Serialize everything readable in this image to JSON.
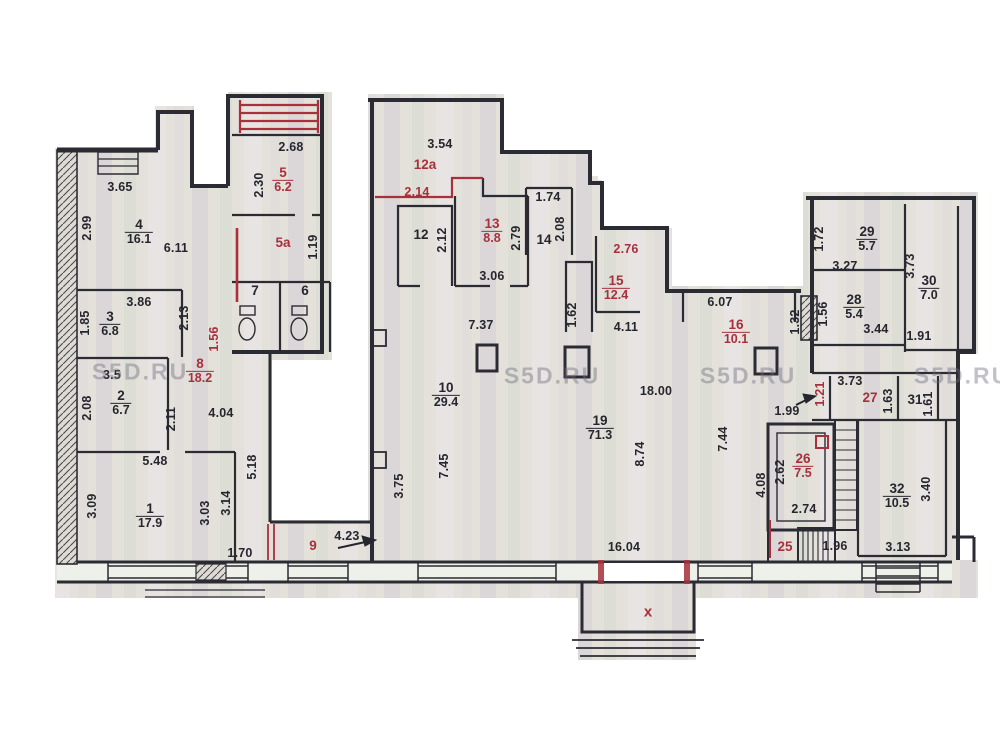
{
  "watermark": {
    "text": "S5D.RU",
    "positions": [
      {
        "x": 140,
        "y": 372
      },
      {
        "x": 552,
        "y": 376
      },
      {
        "x": 748,
        "y": 376
      },
      {
        "x": 962,
        "y": 376
      }
    ]
  },
  "marks": {
    "porch_x": {
      "text": "x",
      "x": 648,
      "y": 612
    }
  },
  "colors": {
    "red": "#a8303c",
    "ink": "#26262e",
    "scan": "#e4e1da"
  },
  "rooms": [
    {
      "num": "1",
      "area": "17.9",
      "x": 150,
      "y": 516,
      "red": false
    },
    {
      "num": "2",
      "area": "6.7",
      "x": 121,
      "y": 403,
      "red": false
    },
    {
      "num": "3",
      "area": "6.8",
      "x": 110,
      "y": 324,
      "red": false
    },
    {
      "num": "4",
      "area": "16.1",
      "x": 139,
      "y": 232,
      "red": false
    },
    {
      "num": "5",
      "area": "6.2",
      "x": 283,
      "y": 180,
      "red": true
    },
    {
      "num": "5a",
      "area": "",
      "x": 283,
      "y": 243,
      "red": true
    },
    {
      "num": "7",
      "area": "",
      "x": 255,
      "y": 291,
      "red": false
    },
    {
      "num": "6",
      "area": "",
      "x": 305,
      "y": 291,
      "red": false
    },
    {
      "num": "8",
      "area": "18.2",
      "x": 200,
      "y": 371,
      "red": true
    },
    {
      "num": "9",
      "area": "",
      "x": 313,
      "y": 546,
      "red": true
    },
    {
      "num": "10",
      "area": "29.4",
      "x": 446,
      "y": 395,
      "red": false
    },
    {
      "num": "12",
      "area": "",
      "x": 421,
      "y": 235,
      "red": false
    },
    {
      "num": "12a",
      "area": "",
      "x": 425,
      "y": 165,
      "red": true
    },
    {
      "num": "13",
      "area": "8.8",
      "x": 492,
      "y": 231,
      "red": true
    },
    {
      "num": "14",
      "area": "",
      "x": 544,
      "y": 240,
      "red": false
    },
    {
      "num": "15",
      "area": "12.4",
      "x": 616,
      "y": 288,
      "red": true
    },
    {
      "num": "16",
      "area": "10.1",
      "x": 736,
      "y": 332,
      "red": true
    },
    {
      "num": "19",
      "area": "71.3",
      "x": 600,
      "y": 428,
      "red": false
    },
    {
      "num": "25",
      "area": "",
      "x": 785,
      "y": 547,
      "red": true
    },
    {
      "num": "26",
      "area": "7.5",
      "x": 803,
      "y": 466,
      "red": true
    },
    {
      "num": "27",
      "area": "",
      "x": 870,
      "y": 398,
      "red": true
    },
    {
      "num": "28",
      "area": "5.4",
      "x": 854,
      "y": 307,
      "red": false
    },
    {
      "num": "29",
      "area": "5.7",
      "x": 867,
      "y": 239,
      "red": false
    },
    {
      "num": "30",
      "area": "7.0",
      "x": 929,
      "y": 288,
      "red": false
    },
    {
      "num": "31",
      "area": "",
      "x": 915,
      "y": 400,
      "red": false
    },
    {
      "num": "32",
      "area": "10.5",
      "x": 897,
      "y": 496,
      "red": false
    }
  ],
  "dimensions": [
    {
      "t": "3.65",
      "x": 120,
      "y": 187,
      "v": false,
      "red": false
    },
    {
      "t": "2.99",
      "x": 87,
      "y": 228,
      "v": true,
      "red": false
    },
    {
      "t": "6.11",
      "x": 176,
      "y": 248,
      "v": false,
      "red": false
    },
    {
      "t": "2.68",
      "x": 291,
      "y": 147,
      "v": false,
      "red": false
    },
    {
      "t": "2.30",
      "x": 259,
      "y": 185,
      "v": true,
      "red": false
    },
    {
      "t": "1.19",
      "x": 313,
      "y": 247,
      "v": true,
      "red": false
    },
    {
      "t": "3.86",
      "x": 139,
      "y": 302,
      "v": false,
      "red": false
    },
    {
      "t": "1.85",
      "x": 85,
      "y": 323,
      "v": true,
      "red": false
    },
    {
      "t": "2.13",
      "x": 184,
      "y": 318,
      "v": true,
      "red": false
    },
    {
      "t": "1.56",
      "x": 214,
      "y": 339,
      "v": true,
      "red": true
    },
    {
      "t": "3.5",
      "x": 112,
      "y": 375,
      "v": false,
      "red": false
    },
    {
      "t": "2.08",
      "x": 87,
      "y": 408,
      "v": true,
      "red": false
    },
    {
      "t": "2.11",
      "x": 171,
      "y": 419,
      "v": true,
      "red": false
    },
    {
      "t": "4.04",
      "x": 221,
      "y": 413,
      "v": false,
      "red": false
    },
    {
      "t": "5.48",
      "x": 155,
      "y": 461,
      "v": false,
      "red": false
    },
    {
      "t": "5.18",
      "x": 252,
      "y": 467,
      "v": true,
      "red": false
    },
    {
      "t": "3.09",
      "x": 92,
      "y": 506,
      "v": true,
      "red": false
    },
    {
      "t": "3.03",
      "x": 205,
      "y": 513,
      "v": true,
      "red": false
    },
    {
      "t": "3.14",
      "x": 226,
      "y": 503,
      "v": true,
      "red": false
    },
    {
      "t": "1.70",
      "x": 240,
      "y": 553,
      "v": false,
      "red": false
    },
    {
      "t": "4.23",
      "x": 347,
      "y": 536,
      "v": false,
      "red": false
    },
    {
      "t": "3.54",
      "x": 440,
      "y": 144,
      "v": false,
      "red": false
    },
    {
      "t": "2.14",
      "x": 417,
      "y": 192,
      "v": false,
      "red": true
    },
    {
      "t": "2.12",
      "x": 442,
      "y": 240,
      "v": true,
      "red": false
    },
    {
      "t": "2.79",
      "x": 516,
      "y": 238,
      "v": true,
      "red": false
    },
    {
      "t": "3.06",
      "x": 492,
      "y": 276,
      "v": false,
      "red": false
    },
    {
      "t": "1.74",
      "x": 548,
      "y": 197,
      "v": false,
      "red": false
    },
    {
      "t": "2.08",
      "x": 560,
      "y": 229,
      "v": true,
      "red": false
    },
    {
      "t": "1.62",
      "x": 572,
      "y": 315,
      "v": true,
      "red": false
    },
    {
      "t": "2.76",
      "x": 626,
      "y": 249,
      "v": false,
      "red": true
    },
    {
      "t": "4.11",
      "x": 626,
      "y": 327,
      "v": false,
      "red": false
    },
    {
      "t": "7.37",
      "x": 481,
      "y": 325,
      "v": false,
      "red": false
    },
    {
      "t": "3.75",
      "x": 399,
      "y": 486,
      "v": true,
      "red": false
    },
    {
      "t": "7.45",
      "x": 444,
      "y": 466,
      "v": true,
      "red": false
    },
    {
      "t": "18.00",
      "x": 656,
      "y": 391,
      "v": false,
      "red": false
    },
    {
      "t": "8.74",
      "x": 640,
      "y": 454,
      "v": true,
      "red": false
    },
    {
      "t": "6.07",
      "x": 720,
      "y": 302,
      "v": false,
      "red": false
    },
    {
      "t": "1.32",
      "x": 795,
      "y": 322,
      "v": true,
      "red": false
    },
    {
      "t": "7.44",
      "x": 723,
      "y": 439,
      "v": true,
      "red": false
    },
    {
      "t": "1.99",
      "x": 787,
      "y": 411,
      "v": false,
      "red": false
    },
    {
      "t": "16.04",
      "x": 624,
      "y": 547,
      "v": false,
      "red": false
    },
    {
      "t": "1.72",
      "x": 819,
      "y": 239,
      "v": true,
      "red": false
    },
    {
      "t": "3.27",
      "x": 845,
      "y": 266,
      "v": false,
      "red": false
    },
    {
      "t": "1.56",
      "x": 823,
      "y": 314,
      "v": true,
      "red": false
    },
    {
      "t": "3.44",
      "x": 876,
      "y": 329,
      "v": false,
      "red": false
    },
    {
      "t": "3.73",
      "x": 910,
      "y": 266,
      "v": true,
      "red": false
    },
    {
      "t": "1.91",
      "x": 919,
      "y": 336,
      "v": false,
      "red": false
    },
    {
      "t": "3.73",
      "x": 850,
      "y": 381,
      "v": false,
      "red": false
    },
    {
      "t": "1.21",
      "x": 820,
      "y": 394,
      "v": true,
      "red": true
    },
    {
      "t": "1.63",
      "x": 888,
      "y": 401,
      "v": true,
      "red": false
    },
    {
      "t": "1.61",
      "x": 928,
      "y": 404,
      "v": true,
      "red": false
    },
    {
      "t": "2.62",
      "x": 780,
      "y": 472,
      "v": true,
      "red": false
    },
    {
      "t": "2.74",
      "x": 804,
      "y": 509,
      "v": false,
      "red": false
    },
    {
      "t": "4.08",
      "x": 761,
      "y": 485,
      "v": true,
      "red": false
    },
    {
      "t": "1.96",
      "x": 835,
      "y": 546,
      "v": false,
      "red": false
    },
    {
      "t": "3.40",
      "x": 926,
      "y": 489,
      "v": true,
      "red": false
    },
    {
      "t": "3.13",
      "x": 898,
      "y": 547,
      "v": false,
      "red": false
    }
  ]
}
